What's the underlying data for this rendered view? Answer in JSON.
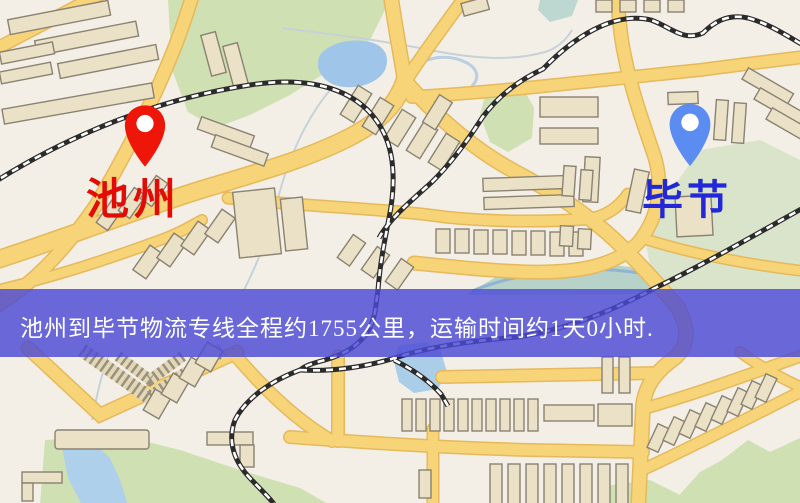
{
  "origin": {
    "name": "池州"
  },
  "destination": {
    "name": "毕节"
  },
  "banner": {
    "text": "池州到毕节物流专线全程约1755公里，运输时间约1天0小时."
  },
  "colors": {
    "banner_bg": "#4c4ad6",
    "banner_text": "#ffffff",
    "origin_pin": "#ee1509",
    "origin_label": "#e20b06",
    "destination_pin": "#5b8cf2",
    "destination_label": "#2228d8",
    "road_fill": "#f6d477",
    "road_edge": "#e5b95c",
    "building_fill": "#eae1c6",
    "park_green": "#cfe0b2",
    "water_blue": "#a3c8e8",
    "railway": "#2b2b2b",
    "map_background": "#f3efe6"
  }
}
